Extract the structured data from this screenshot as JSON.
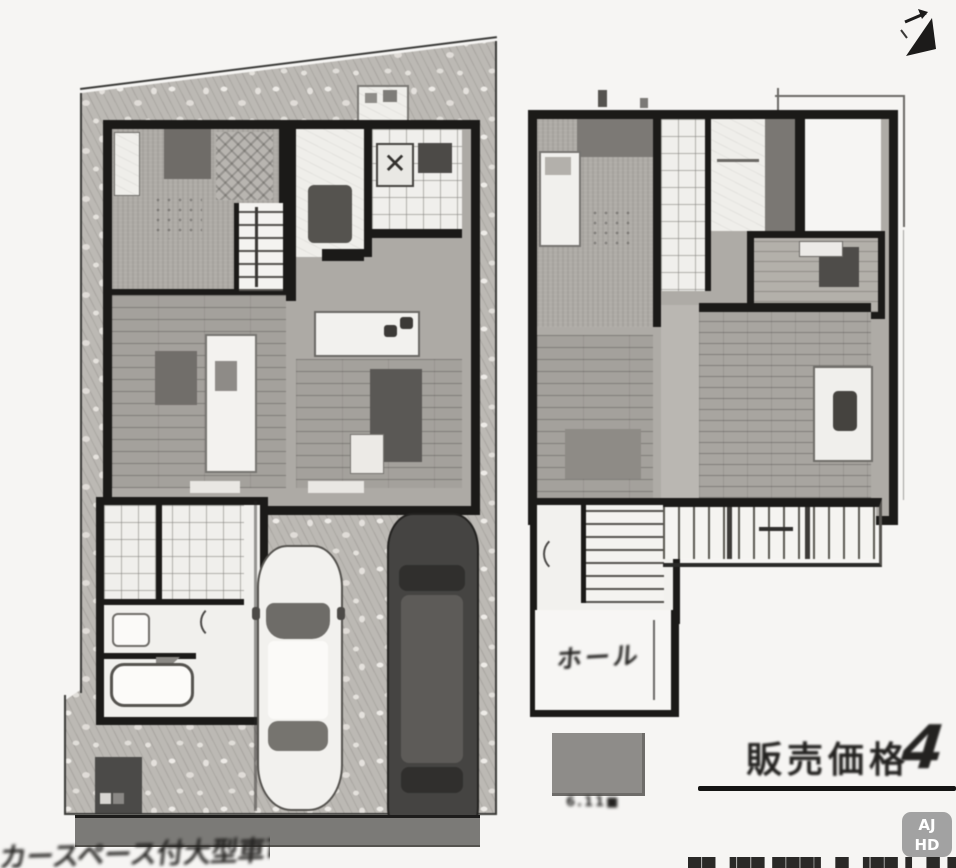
{
  "page": {
    "background": "#f6f5f3"
  },
  "colors": {
    "wall": "#1b1a18",
    "site_texture": "#bcb9b4",
    "rule_line": "#141413",
    "watermark_bg": "#9a9a9a"
  },
  "icons": {
    "north_arrow": "north-arrow-icon",
    "car_white": "car-top-view-white-icon",
    "car_dark": "car-top-view-dark-icon"
  },
  "labels": {
    "hall": "ホール",
    "legend_caption": "6.11■",
    "note_bottom_left": "カースペース付大型車可。",
    "price_label": "販売価格",
    "price_partial_digit": "4",
    "clipped_bottom_text": "██ ▐██ ███▌ █ ▐██ ▌ █ █"
  },
  "watermark": {
    "line1": "AJ",
    "line2": "HD"
  }
}
